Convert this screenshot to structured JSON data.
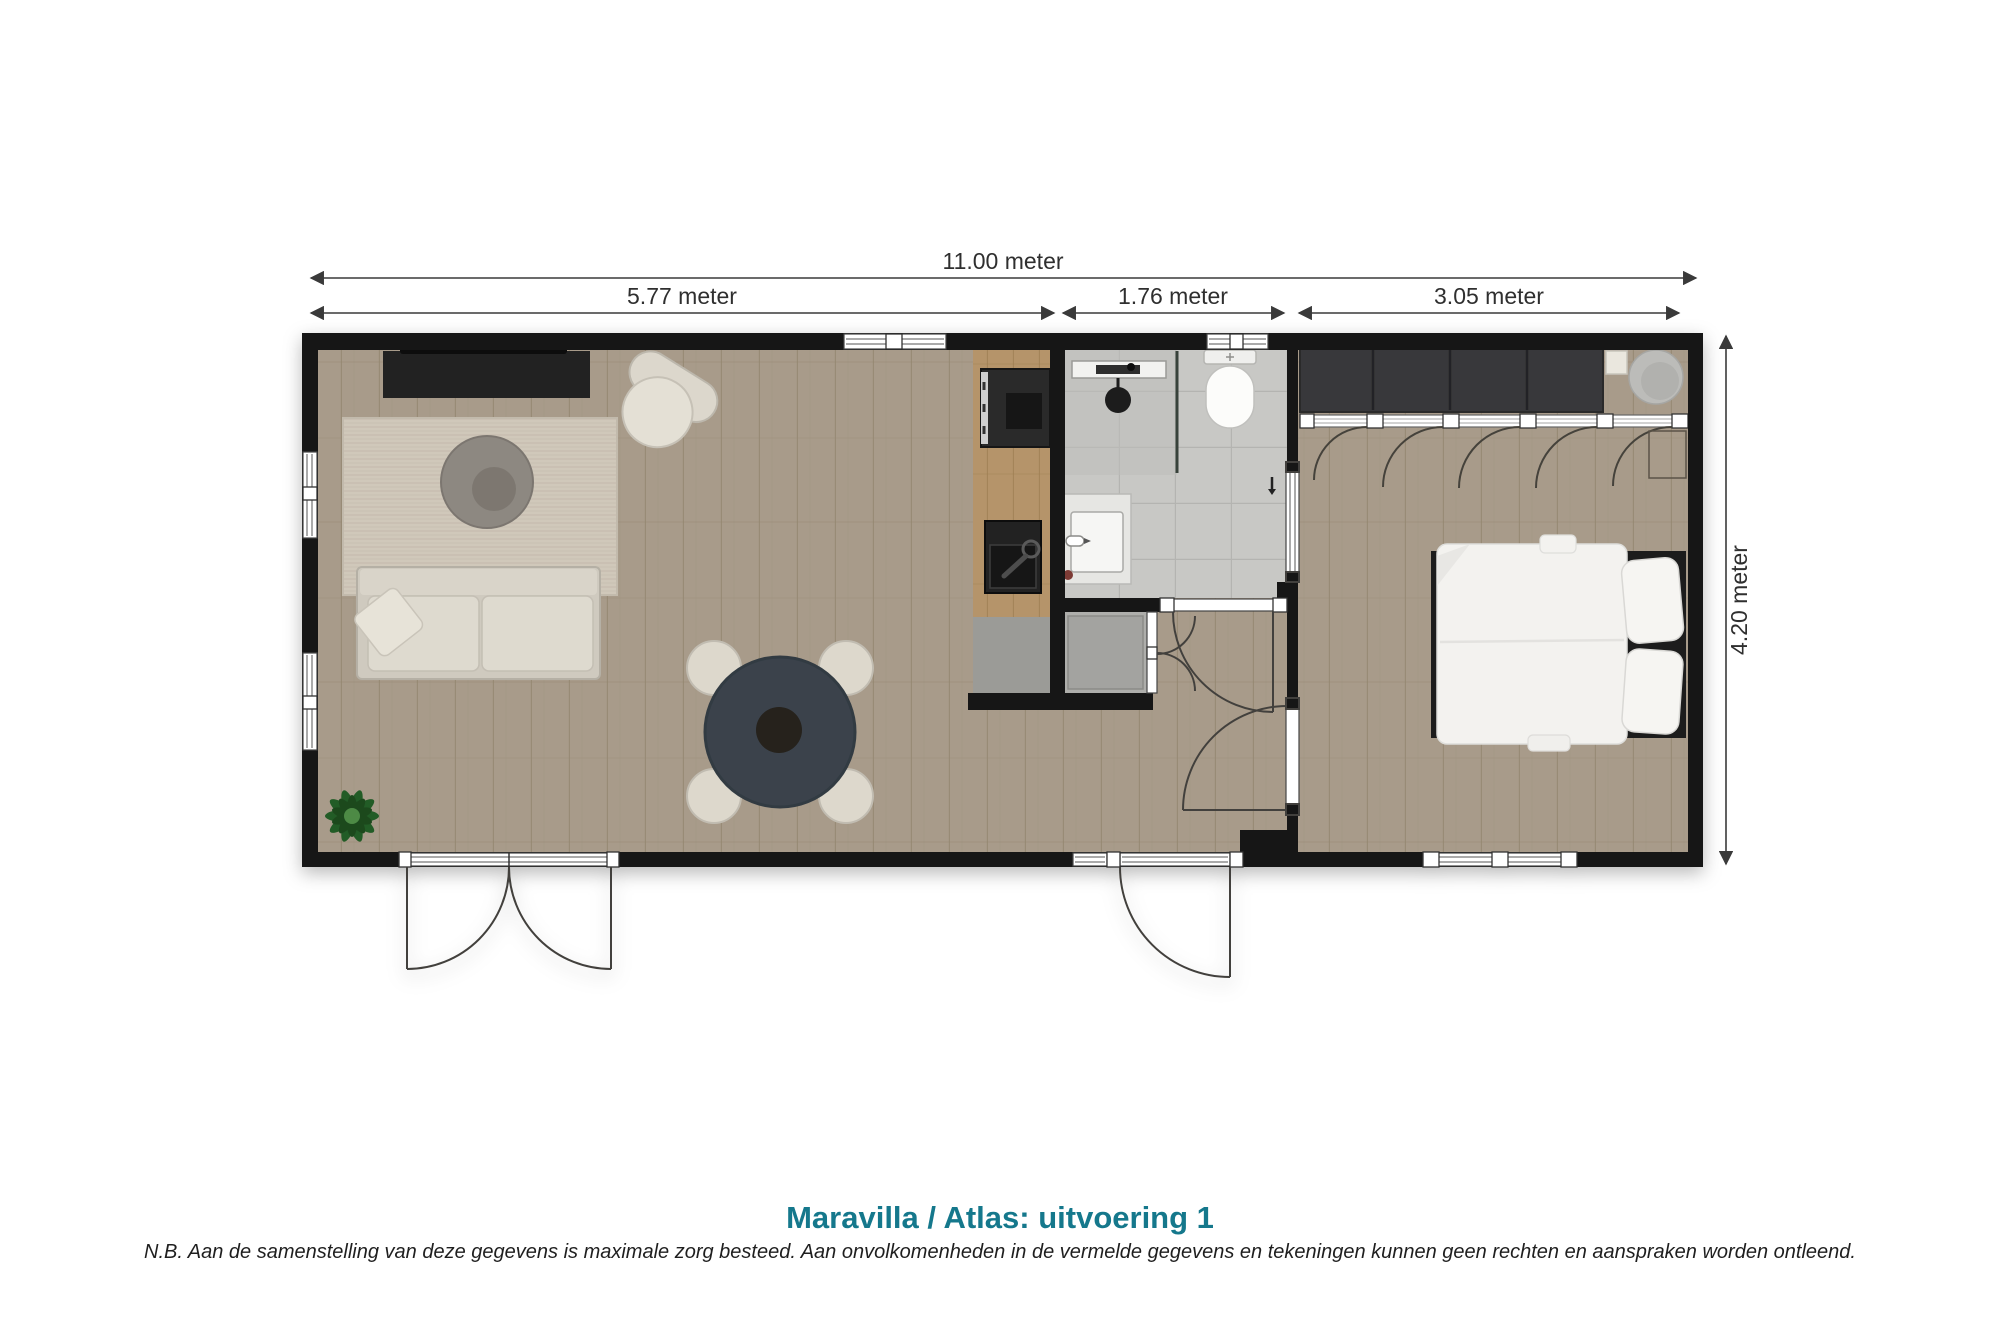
{
  "title": {
    "text": "Maravilla / Atlas: uitvoering 1",
    "color": "#15788c"
  },
  "disclaimer": {
    "text": "N.B. Aan de samenstelling van deze gegevens is maximale zorg besteed. Aan onvolkomenheden in de vermelde gegevens en tekeningen kunnen geen rechten en aanspraken worden ontleend."
  },
  "dimensions": {
    "overall_width": "11.00 meter",
    "living_width": "5.77 meter",
    "hall_width": "1.76 meter",
    "bedroom_width": "3.05 meter",
    "overall_depth": "4.20 meter"
  },
  "colors": {
    "wall": "#171717",
    "wood_floor": "#a89b8a",
    "kitchen_counter_wood": "#b5946a",
    "bathroom_tile": "#c8c8c5",
    "closet_floor": "#aeaeab",
    "furniture_cream": "#d9d4c9",
    "table_dark": "#3a434c",
    "title_teal": "#15788c"
  },
  "features": [
    "tv-cabinet",
    "armchair",
    "area-rug",
    "round-pouf",
    "sofa",
    "throw-pillow",
    "plant",
    "dining-table",
    "dining-chair",
    "kitchen-cooktop",
    "kitchen-sink",
    "entry-mat",
    "shower-rail",
    "shower-head",
    "shower-screen",
    "toilet",
    "washbasin",
    "wall-hook",
    "washing-machine-closet",
    "wardrobe",
    "wardrobe-door",
    "shelf",
    "bedroom-pouf",
    "bedside-table",
    "double-bed",
    "pillow",
    "patio-double-door",
    "side-entrance-door",
    "bathroom-door",
    "bedroom-door",
    "closet-bifold-door",
    "sliding-door",
    "window"
  ]
}
